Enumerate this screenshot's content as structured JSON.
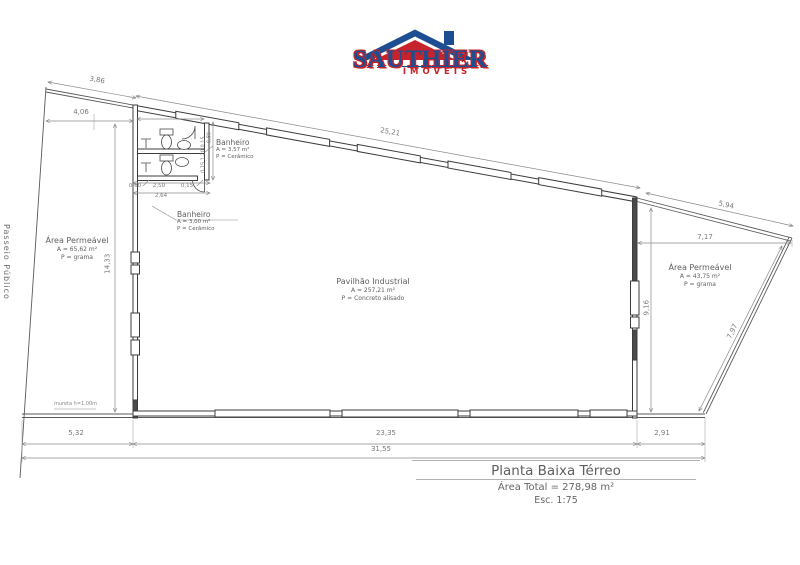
{
  "logo": {
    "brand": "SAUTHIER",
    "subtitle": "IMÓVEIS",
    "colors": {
      "blue": "#1d4e91",
      "red": "#c6242a"
    }
  },
  "labels": {
    "passeio": "Passeio Público",
    "mureta": "mureta h=1,00m",
    "area_left": {
      "title": "Área Permeável",
      "area": "A = 65,62 m²",
      "floor": "P = grama"
    },
    "area_right": {
      "title": "Área Permeável",
      "area": "A = 43,75 m²",
      "floor": "P = grama"
    },
    "pavilion": {
      "title": "Pavilhão Industrial",
      "area": "A = 257,21 m²",
      "floor": "P = Concreto alisado"
    },
    "bath_top": {
      "title": "Banheiro",
      "area": "A = 3,57 m²",
      "floor": "P = Cerâmico"
    },
    "bath_bottom": {
      "title": "Banheiro",
      "area": "A = 3,00 m²",
      "floor": "P = Cerâmico"
    }
  },
  "dims": {
    "top_left_slant": "3,86",
    "top_left_h": "4,06",
    "top_wall": "25,21",
    "top_right_slant": "5,94",
    "right_h": "7,17",
    "left_v": "14,33",
    "right_wall_v": "9,16",
    "right_boundary": "7,97",
    "bottom_left": "5,32",
    "bottom_center": "23,35",
    "bottom_right": "2,91",
    "bottom_total": "31,55",
    "bath_w1": "0,60",
    "bath_w2": "2,50",
    "bath_w3": "0,15",
    "bath_total": "2,64",
    "bath_v": "0,15 1,20 0,15",
    "bath_door": "0,80"
  },
  "titleblock": {
    "title": "Planta Baixa Térreo",
    "area_total": "Área Total = 278,98 m²",
    "scale": "Esc. 1:75"
  }
}
